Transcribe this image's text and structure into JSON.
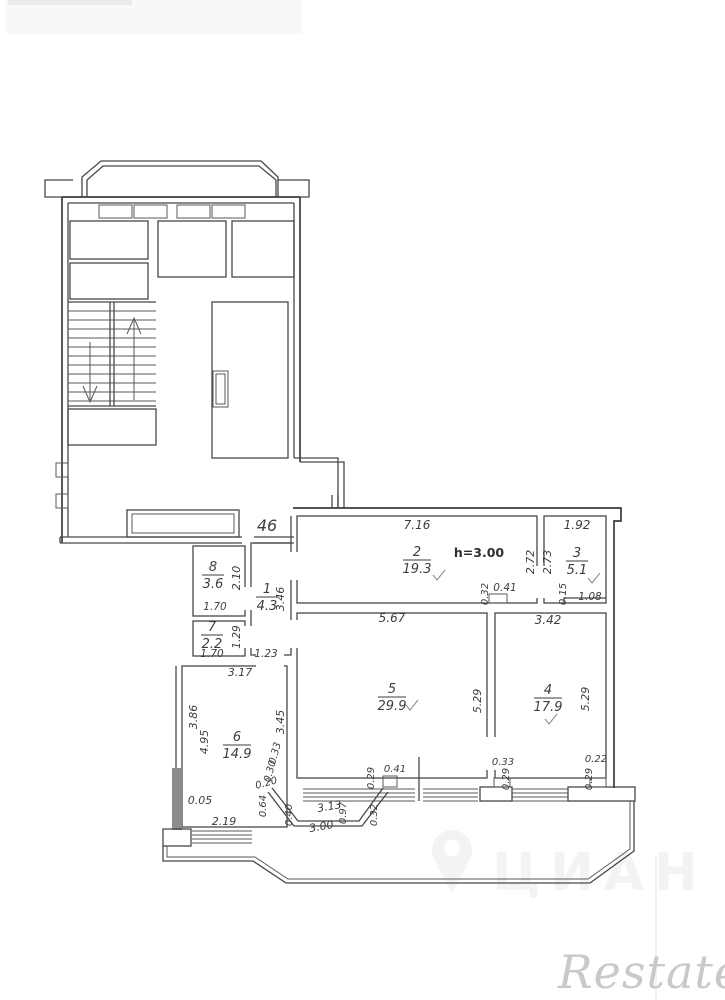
{
  "plan": {
    "apartment_number": "46",
    "ceiling_height": "h=3.00"
  },
  "rooms": {
    "items": [
      {
        "number": "8",
        "area": "3.6",
        "x": 213,
        "y": 571,
        "lw": 22
      },
      {
        "number": "7",
        "area": "2.2",
        "x": 212,
        "y": 631,
        "lw": 22
      },
      {
        "number": "1",
        "area": "4.3",
        "x": 267,
        "y": 593,
        "lw": 22
      },
      {
        "number": "2",
        "area": "19.3",
        "x": 417,
        "y": 556,
        "lw": 28
      },
      {
        "number": "3",
        "area": "5.1",
        "x": 577,
        "y": 557,
        "lw": 22
      },
      {
        "number": "5",
        "area": "29.9",
        "x": 392,
        "y": 693,
        "lw": 28
      },
      {
        "number": "4",
        "area": "17.9",
        "x": 548,
        "y": 694,
        "lw": 28
      },
      {
        "number": "6",
        "area": "14.9",
        "x": 237,
        "y": 741,
        "lw": 28
      }
    ]
  },
  "dimensions": {
    "items": [
      {
        "t": "7.16",
        "x": 417,
        "y": 529,
        "r": 0,
        "s": 12
      },
      {
        "t": "1.92",
        "x": 577,
        "y": 529,
        "r": 0,
        "s": 12
      },
      {
        "t": "2.72",
        "x": 534,
        "y": 562,
        "r": -90,
        "s": 11
      },
      {
        "t": "2.73",
        "x": 551,
        "y": 562,
        "r": -90,
        "s": 11
      },
      {
        "t": "0.32",
        "x": 488,
        "y": 594,
        "r": -90,
        "s": 10
      },
      {
        "t": "0.41",
        "x": 505,
        "y": 591,
        "r": 0,
        "s": 10.5
      },
      {
        "t": "0.15",
        "x": 566,
        "y": 594,
        "r": -90,
        "s": 10
      },
      {
        "t": "1.08",
        "x": 590,
        "y": 600,
        "r": 0,
        "s": 10.5
      },
      {
        "t": "5.67",
        "x": 392,
        "y": 622,
        "r": 0,
        "s": 12
      },
      {
        "t": "3.42",
        "x": 548,
        "y": 624,
        "r": 0,
        "s": 12
      },
      {
        "t": "2.10",
        "x": 240,
        "y": 578,
        "r": -90,
        "s": 11
      },
      {
        "t": "1.70",
        "x": 215,
        "y": 610,
        "r": 0,
        "s": 10.5
      },
      {
        "t": "1.29",
        "x": 240,
        "y": 637,
        "r": -90,
        "s": 10.5
      },
      {
        "t": "1.70",
        "x": 212,
        "y": 657,
        "r": 0,
        "s": 10.5
      },
      {
        "t": "3.46",
        "x": 284,
        "y": 599,
        "r": -90,
        "s": 11
      },
      {
        "t": "1.23",
        "x": 266,
        "y": 657,
        "r": 0,
        "s": 10.5
      },
      {
        "t": "3.17",
        "x": 240,
        "y": 676,
        "r": 0,
        "s": 11
      },
      {
        "t": "3.86",
        "x": 197,
        "y": 717,
        "r": -90,
        "s": 11
      },
      {
        "t": "4.95",
        "x": 208,
        "y": 742,
        "r": -90,
        "s": 11
      },
      {
        "t": "3.45",
        "x": 284,
        "y": 722,
        "r": -90,
        "s": 11
      },
      {
        "t": "5.29",
        "x": 481,
        "y": 701,
        "r": -90,
        "s": 11
      },
      {
        "t": "5.29",
        "x": 589,
        "y": 699,
        "r": -90,
        "s": 11
      },
      {
        "t": "0.33",
        "x": 278,
        "y": 754,
        "r": -75,
        "s": 10
      },
      {
        "t": "0.30",
        "x": 273,
        "y": 772,
        "r": -75,
        "s": 10
      },
      {
        "t": "0.20",
        "x": 267,
        "y": 786,
        "r": -15,
        "s": 10
      },
      {
        "t": "0.64",
        "x": 266,
        "y": 806,
        "r": -90,
        "s": 10
      },
      {
        "t": "0.05",
        "x": 200,
        "y": 804,
        "r": 0,
        "s": 11
      },
      {
        "t": "2.19",
        "x": 224,
        "y": 825,
        "r": 0,
        "s": 11
      },
      {
        "t": "0.40",
        "x": 292,
        "y": 815,
        "r": -90,
        "s": 10
      },
      {
        "t": "3.13",
        "x": 330,
        "y": 810,
        "r": -10,
        "s": 11
      },
      {
        "t": "0.97",
        "x": 346,
        "y": 813,
        "r": -90,
        "s": 10
      },
      {
        "t": "3.00",
        "x": 322,
        "y": 830,
        "r": -10,
        "s": 11
      },
      {
        "t": "0.32",
        "x": 377,
        "y": 815,
        "r": -90,
        "s": 10
      },
      {
        "t": "0.29",
        "x": 374,
        "y": 778,
        "r": -90,
        "s": 10
      },
      {
        "t": "0.41",
        "x": 395,
        "y": 772,
        "r": 0,
        "s": 10
      },
      {
        "t": "0.33",
        "x": 503,
        "y": 765,
        "r": 0,
        "s": 10
      },
      {
        "t": "0.29",
        "x": 509,
        "y": 779,
        "r": -90,
        "s": 10
      },
      {
        "t": "0.22",
        "x": 596,
        "y": 762,
        "r": 0,
        "s": 10
      },
      {
        "t": "0.29",
        "x": 592,
        "y": 779,
        "r": -90,
        "s": 10
      }
    ]
  },
  "watermarks": {
    "restate": "Restate",
    "cian": "ЦИАН"
  }
}
